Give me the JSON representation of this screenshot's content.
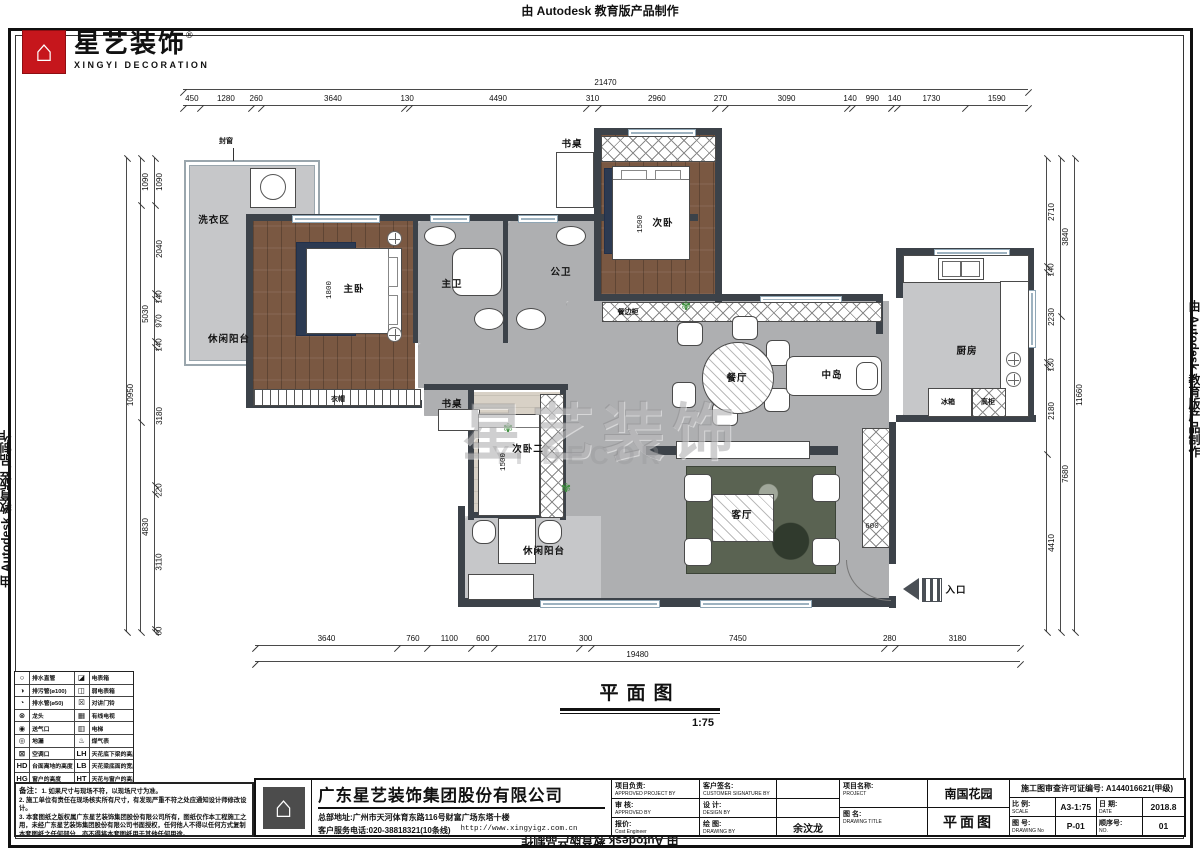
{
  "edge": {
    "top": "由 Autodesk 教育版产品制作",
    "bottom": "由 Autodesk 教育版产品制作",
    "left": "由 Autodesk 教育版产品制作",
    "right": "由 Autodesk 教育版产品制作"
  },
  "logo": {
    "house": "⌂",
    "cn": "星艺装饰",
    "reg": "®",
    "en": "XINGYI DECORATION"
  },
  "watermark": {
    "cn": "星艺装饰",
    "en": "YI DECOR"
  },
  "plan_title": {
    "cn": "平面图",
    "scale": "1:75"
  },
  "colors": {
    "wall": "#3c4249",
    "wood_floor": "#7a5842",
    "marble_floor": "#aeafb1",
    "logo_red": "#c6161c",
    "accent_plant": "#3f8f3f"
  },
  "dimensions": {
    "top": {
      "total": "21470",
      "segments": [
        "450",
        "1280",
        "260",
        "3640",
        "130",
        "4490",
        "310",
        "2960",
        "270",
        "3090",
        "140",
        "990",
        "140",
        "1730",
        "1590"
      ]
    },
    "bottom": {
      "total": "19480",
      "segments": [
        "3640",
        "760",
        "1100",
        "600",
        "2170",
        "300",
        "7450",
        "280",
        "3180"
      ]
    },
    "left": {
      "total": "10950",
      "mid": [
        "1090",
        "5030",
        "4830"
      ],
      "segments": [
        "1090",
        "2040",
        "140",
        "970",
        "140",
        "3180",
        "220",
        "3110",
        "60"
      ]
    },
    "right": {
      "total": "11660",
      "mid": [
        "3840",
        "7680"
      ],
      "segments": [
        "2710",
        "140",
        "2230",
        "130",
        "2180",
        "4410"
      ]
    }
  },
  "room_labels": [
    {
      "text": "封窗",
      "x": 226,
      "y": 141,
      "cls": "small"
    },
    {
      "text": "洗衣区",
      "x": 214,
      "y": 219,
      "cls": "room"
    },
    {
      "text": "休闲阳台",
      "x": 229,
      "y": 338,
      "cls": "room"
    },
    {
      "text": "主卧",
      "x": 354,
      "y": 288,
      "cls": "room"
    },
    {
      "text": "1800",
      "x": 330,
      "y": 290,
      "cls": "dim",
      "vert": true
    },
    {
      "text": "主卫",
      "x": 452,
      "y": 283,
      "cls": "room"
    },
    {
      "text": "公卫",
      "x": 561,
      "y": 271,
      "cls": "room"
    },
    {
      "text": "书桌",
      "x": 572,
      "y": 143,
      "cls": "room"
    },
    {
      "text": "次卧",
      "x": 663,
      "y": 222,
      "cls": "room"
    },
    {
      "text": "1500",
      "x": 641,
      "y": 224,
      "cls": "dim",
      "vert": true
    },
    {
      "text": "餐边柜",
      "x": 628,
      "y": 312,
      "cls": "small"
    },
    {
      "text": "餐厅",
      "x": 737,
      "y": 377,
      "cls": "room"
    },
    {
      "text": "中岛",
      "x": 832,
      "y": 374,
      "cls": "room"
    },
    {
      "text": "厨房",
      "x": 967,
      "y": 350,
      "cls": "room"
    },
    {
      "text": "冰箱",
      "x": 948,
      "y": 402,
      "cls": "small"
    },
    {
      "text": "高柜",
      "x": 988,
      "y": 402,
      "cls": "small"
    },
    {
      "text": "衣帽",
      "x": 338,
      "y": 399,
      "cls": "small"
    },
    {
      "text": "书桌",
      "x": 452,
      "y": 403,
      "cls": "room"
    },
    {
      "text": "次卧二",
      "x": 528,
      "y": 448,
      "cls": "room"
    },
    {
      "text": "1500",
      "x": 504,
      "y": 462,
      "cls": "dim",
      "vert": true
    },
    {
      "text": "休闲阳台",
      "x": 544,
      "y": 550,
      "cls": "room"
    },
    {
      "text": "客厅",
      "x": 742,
      "y": 514,
      "cls": "room"
    },
    {
      "text": "600",
      "x": 872,
      "y": 527,
      "cls": "dim"
    },
    {
      "text": "入口",
      "x": 956,
      "y": 589,
      "cls": "room"
    }
  ],
  "legend": {
    "rows": [
      {
        "ls": "○",
        "ll": "排水直管",
        "rs": "◪",
        "rl": "电表箱"
      },
      {
        "ls": "◑",
        "ll": "排污管(ø100)",
        "rs": "◫",
        "rl": "弱电表箱"
      },
      {
        "ls": "◔",
        "ll": "排水管(ø50)",
        "rs": "☒",
        "rl": "对讲门铃"
      },
      {
        "ls": "⊗",
        "ll": "龙头",
        "rs": "▦",
        "rl": "有线电视"
      },
      {
        "ls": "◉",
        "ll": "送气口",
        "rs": "▥",
        "rl": "电梯"
      },
      {
        "ls": "◎",
        "ll": "地漏",
        "rs": "♨",
        "rl": "煤气表"
      },
      {
        "ls": "⊠",
        "ll": "空调口",
        "rs": "LH",
        "rl": "天花底下梁的高度"
      },
      {
        "ls": "HD",
        "ll": "台面离地的高度",
        "rs": "LB",
        "rl": "天花梁底面的宽度"
      },
      {
        "ls": "HG",
        "ll": "窗户的高度",
        "rs": "HT",
        "rl": "天花与窗户的高度"
      }
    ]
  },
  "notes": {
    "title": "备注：",
    "lines": [
      "1. 如果尺寸与现场不符，以现场尺寸为准。",
      "2. 施工单位有责任在现场核实所有尺寸，有发现严重不符之处应通知设计师修改设计。",
      "3. 本套图纸之版权属广东星艺装饰集团股份有限公司所有，图纸仅作本工程施工之用，未经广东星艺装饰集团股份有限公司书面授权，任何他人不得以任何方式复制本套图纸之任何部分，亦不得将本套图纸用于其他任何用途。"
    ]
  },
  "titleblock": {
    "company": {
      "name": "广东星艺装饰集团股份有限公司",
      "address": "总部地址:广州市天河体育东路116号财富广场东塔十楼",
      "phone": "客户服务电话:020-38818321(10条线)",
      "url": "http://www.xingyigz.com.cn"
    },
    "col_a": [
      {
        "cn": "项目负责:",
        "en": "APPROVED PROJECT BY"
      },
      {
        "cn": "审 核:",
        "en": "APPROVED BY"
      },
      {
        "cn": "报价:",
        "en": "Cost Engineer"
      }
    ],
    "col_b": [
      {
        "cn": "客户签名:",
        "en": "CUSTOMER SIGNATURE BY",
        "val": ""
      },
      {
        "cn": "设 计:",
        "en": "DESIGN BY",
        "val": ""
      },
      {
        "cn": "绘 图:",
        "en": "DRAWING BY",
        "val": "余汶龙"
      }
    ],
    "project": {
      "cn": "项目名称:",
      "en": "PROJECT",
      "value": "南国花园"
    },
    "drawing": {
      "cn": "图 名:",
      "en": "DRAWING TITLE",
      "value": "平面图"
    },
    "permit": "施工图审查许可证编号: A144016621(甲级)",
    "grid": {
      "scale_cn": "比 例:",
      "scale_en": "SCALE",
      "scale": "A3-1:75",
      "date_cn": "日 期:",
      "date_en": "DATE",
      "date": "2018.8",
      "no_cn": "图 号:",
      "no_en": "DRAWING No",
      "no": "P-01",
      "seq_cn": "顺序号:",
      "seq_en": "NO.",
      "seq": "01"
    }
  }
}
